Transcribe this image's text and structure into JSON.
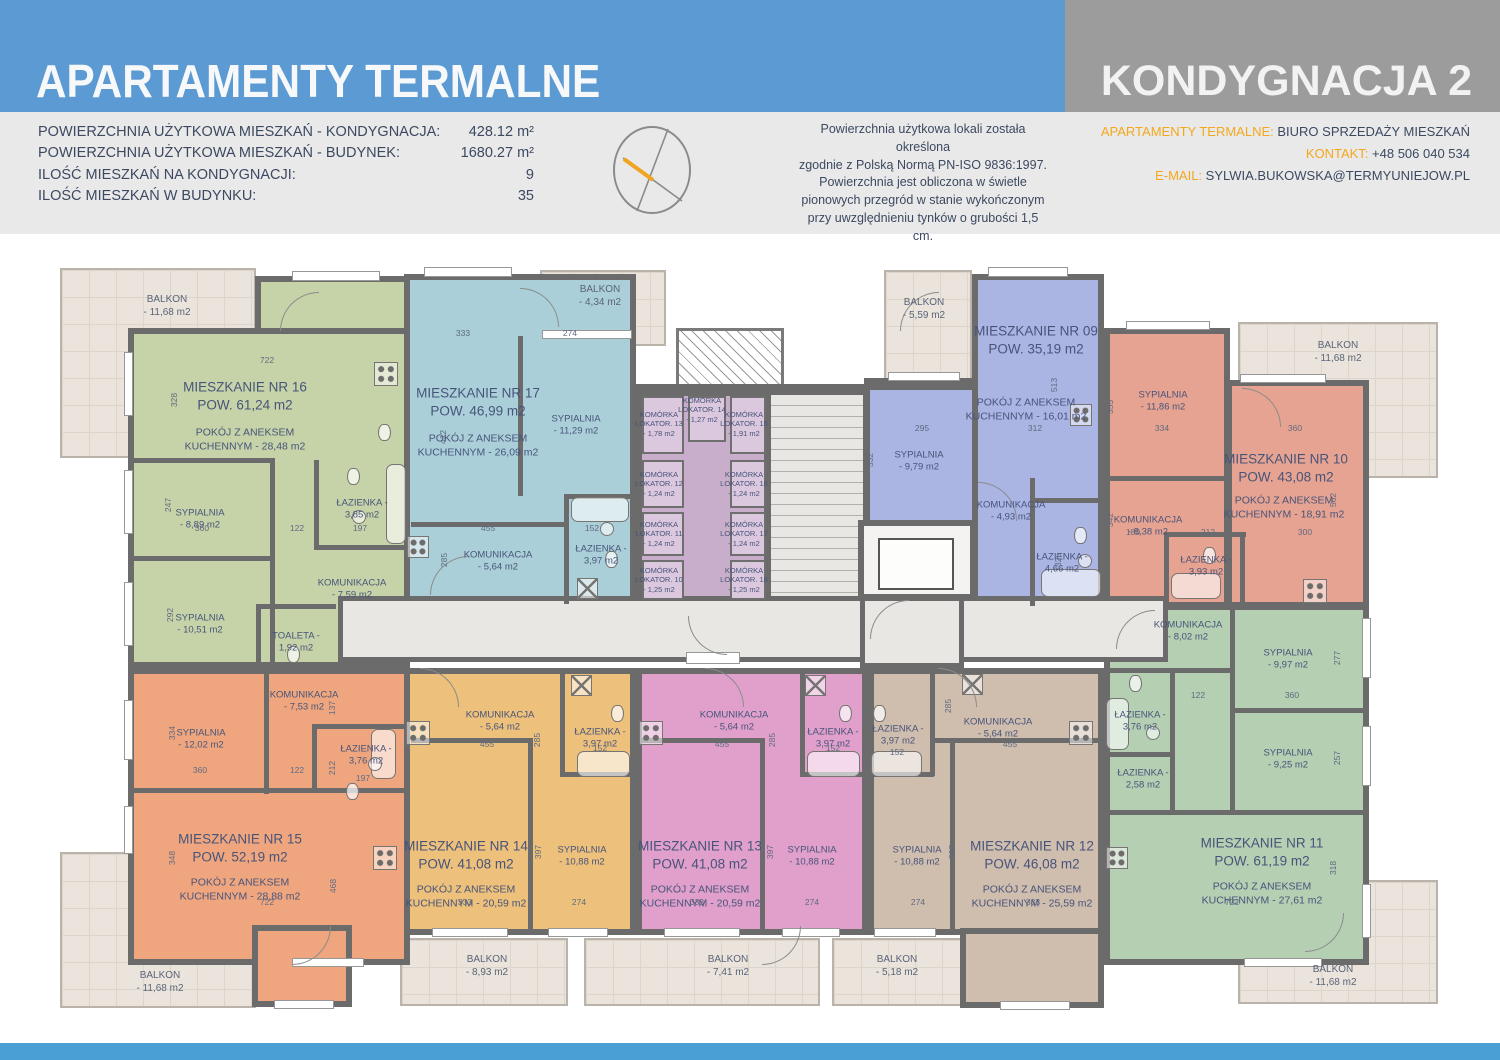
{
  "header": {
    "title": "APARTAMENTY TERMALNE",
    "floor_label": "KONDYGNACJA 2"
  },
  "stats": [
    {
      "label": "POWIERZCHNIA UŻYTKOWA MIESZKAŃ - KONDYGNACJA:",
      "value": "428.12 m²"
    },
    {
      "label": "POWIERZCHNIA UŻYTKOWA MIESZKAŃ - BUDYNEK:",
      "value": "1680.27 m²"
    },
    {
      "label": "ILOŚĆ MIESZKAŃ NA KONDYGNACJI:",
      "value": "9"
    },
    {
      "label": "ILOŚĆ MIESZKAŃ W BUDYNKU:",
      "value": "35"
    }
  ],
  "note_lines": [
    "Powierzchnia użytkowa lokali została określona",
    "zgodnie z Polską Normą PN-ISO 9836:1997.",
    "Powierzchnia jest obliczona w świetle",
    "pionowych przegród w stanie wykończonym",
    "przy uwzględnieniu tynków o grubości 1,5 cm."
  ],
  "contact": {
    "office_label": "APARTAMENTY TERMALNE:",
    "office_value": " BIURO SPRZEDAŻY MIESZKAŃ",
    "phone_label": "KONTAKT:",
    "phone_value": " +48 506 040 534",
    "email_label": "E-MAIL:",
    "email_value": " SYLWIA.BUKOWSKA@TERMYUNIEJOW.PL"
  },
  "plan": {
    "apartments": {
      "a16": {
        "name": "MIESZKANIE NR 16",
        "area": "POW. 61,24 m2",
        "kitchen": [
          "POKÓJ Z ANEKSEM",
          "KUCHENNYM - 28,48 m2"
        ],
        "rooms": [
          [
            "SYPIALNIA",
            "- 8,89 m2"
          ],
          [
            "SYPIALNIA",
            "- 10,51 m2"
          ],
          [
            "ŁAZIENKA -",
            "3,85 m2"
          ],
          [
            "KOMUNIKACJA",
            "- 7,59 m2"
          ],
          [
            "TOALETA -",
            "1,92 m2"
          ]
        ]
      },
      "a17": {
        "name": "MIESZKANIE NR 17",
        "area": "POW. 46,99 m2",
        "kitchen": [
          "POKÓJ Z ANEKSEM",
          "KUCHENNYM - 26,09 m2"
        ],
        "rooms": [
          [
            "SYPIALNIA",
            "- 11,29 m2"
          ],
          [
            "KOMUNIKACJA",
            "- 5,64 m2"
          ],
          [
            "ŁAZIENKA -",
            "3,97 m2"
          ]
        ]
      },
      "a09": {
        "name": "MIESZKANIE NR 09",
        "area": "POW. 35,19 m2",
        "kitchen": [
          "POKÓJ Z ANEKSEM",
          "KUCHENNYM - 16,01 m2"
        ],
        "rooms": [
          [
            "SYPIALNIA",
            "- 9,79 m2"
          ],
          [
            "KOMUNIKACJA",
            "- 4,93 m2"
          ],
          [
            "ŁAZIENKA -",
            "4,66 m2"
          ]
        ]
      },
      "a10": {
        "name": "MIESZKANIE NR 10",
        "area": "POW. 43,08 m2",
        "kitchen": [
          "POKÓJ Z ANEKSEM",
          "KUCHENNYM - 18,91 m2"
        ],
        "rooms": [
          [
            "SYPIALNIA",
            "- 11,86 m2"
          ],
          [
            "KOMUNIKACJA",
            "- 8,38 m2"
          ],
          [
            "ŁAZIENKA -",
            "3,93 m2"
          ]
        ]
      },
      "a15": {
        "name": "MIESZKANIE NR 15",
        "area": "POW. 52,19 m2",
        "kitchen": [
          "POKÓJ Z ANEKSEM",
          "KUCHENNYM - 28,88 m2"
        ],
        "rooms": [
          [
            "SYPIALNIA",
            "- 12,02 m2"
          ],
          [
            "KOMUNIKACJA",
            "- 7,53 m2"
          ],
          [
            "ŁAZIENKA -",
            "3,76 m2"
          ]
        ]
      },
      "a14": {
        "name": "MIESZKANIE NR 14",
        "area": "POW. 41,08 m2",
        "kitchen": [
          "POKÓJ Z ANEKSEM",
          "KUCHENNYM - 20,59 m2"
        ],
        "rooms": [
          [
            "KOMUNIKACJA",
            "- 5,64 m2"
          ],
          [
            "ŁAZIENKA -",
            "3,97 m2"
          ],
          [
            "SYPIALNIA",
            "- 10,88 m2"
          ]
        ]
      },
      "a13": {
        "name": "MIESZKANIE NR 13",
        "area": "POW. 41,08 m2",
        "kitchen": [
          "POKÓJ Z ANEKSEM",
          "KUCHENNYM - 20,59 m2"
        ],
        "rooms": [
          [
            "KOMUNIKACJA",
            "- 5,64 m2"
          ],
          [
            "ŁAZIENKA -",
            "3,97 m2"
          ],
          [
            "SYPIALNIA",
            "- 10,88 m2"
          ]
        ]
      },
      "a12": {
        "name": "MIESZKANIE NR 12",
        "area": "POW. 46,08 m2",
        "kitchen": [
          "POKÓJ Z ANEKSEM",
          "KUCHENNYM - 25,59 m2"
        ],
        "rooms": [
          [
            "ŁAZIENKA -",
            "3,97 m2"
          ],
          [
            "KOMUNIKACJA",
            "- 5,64 m2"
          ],
          [
            "SYPIALNIA",
            "- 10,88 m2"
          ]
        ]
      },
      "a11": {
        "name": "MIESZKANIE NR 11",
        "area": "POW. 61,19 m2",
        "kitchen": [
          "POKÓJ Z ANEKSEM",
          "KUCHENNYM - 27,61 m2"
        ],
        "rooms": [
          [
            "KOMUNIKACJA",
            "- 8,02 m2"
          ],
          [
            "SYPIALNIA",
            "- 9,97 m2"
          ],
          [
            "SYPIALNIA",
            "- 9,25 m2"
          ],
          [
            "ŁAZIENKA -",
            "3,76 m2"
          ],
          [
            "ŁAZIENKA -",
            "2,58 m2"
          ]
        ]
      }
    },
    "storage_units": [
      [
        "KOMÓRKA",
        "LOKATOR. 13",
        "- 1,78 m2"
      ],
      [
        "KOMÓRKA",
        "LOKATOR. 14",
        "- 1,27 m2"
      ],
      [
        "KOMÓRKA",
        "LOKATOR. 15",
        "- 1,91 m2"
      ],
      [
        "KOMÓRKA",
        "LOKATOR. 12",
        "- 1,24 m2"
      ],
      [
        "KOMÓRKA",
        "LOKATOR. 16",
        "- 1,24 m2"
      ],
      [
        "KOMÓRKA",
        "LOKATOR. 11",
        "- 1,24 m2"
      ],
      [
        "KOMÓRKA",
        "LOKATOR. 17",
        "- 1,24 m2"
      ],
      [
        "KOMÓRKA",
        "LOKATOR. 10",
        "- 1,25 m2"
      ],
      [
        "KOMÓRKA",
        "LOKATOR. 18",
        "- 1,25 m2"
      ]
    ],
    "balconies": [
      [
        "BALKON",
        "- 11,68 m2"
      ],
      [
        "BALKON",
        "- 4,34 m2"
      ],
      [
        "BALKON",
        "- 5,59 m2"
      ],
      [
        "BALKON",
        "- 11,68 m2"
      ],
      [
        "BALKON",
        "- 11,68 m2"
      ],
      [
        "BALKON",
        "- 8,93 m2"
      ],
      [
        "BALKON",
        "- 7,41 m2"
      ],
      [
        "BALKON",
        "- 5,18 m2"
      ],
      [
        "BALKON",
        "- 11,68 m2"
      ]
    ],
    "dims": [
      "722",
      "328",
      "247",
      "360",
      "292",
      "122",
      "197",
      "333",
      "274",
      "412",
      "455",
      "285",
      "152",
      "295",
      "332",
      "513",
      "312",
      "355",
      "334",
      "360",
      "562",
      "342",
      "180",
      "212",
      "300",
      "325",
      "122",
      "360",
      "277",
      "257",
      "318",
      "722",
      "137",
      "334",
      "360",
      "122",
      "212",
      "197",
      "348",
      "468",
      "722",
      "455",
      "285",
      "152",
      "397",
      "333",
      "274",
      "455",
      "285",
      "152",
      "397",
      "333",
      "274",
      "285",
      "455",
      "152",
      "397",
      "274",
      "333"
    ]
  },
  "colors": {
    "header_blue": "#5b9ad2",
    "header_gray": "#9c9c9c",
    "accent_orange": "#f3a81c",
    "apt16_green": "#c6d3a8",
    "apt17_teal": "#abcfd8",
    "apt09_blue": "#abb5e3",
    "apt10_salmon": "#e7a391",
    "apt15_orange": "#efa67f",
    "apt14_gold": "#edc07c",
    "apt13_pink": "#e0a0cb",
    "apt12_tan": "#cfbdae",
    "apt11_sage": "#b5cfb3",
    "storage_mauve": "#dcc8de",
    "wall_gray": "#6b6b6b"
  }
}
